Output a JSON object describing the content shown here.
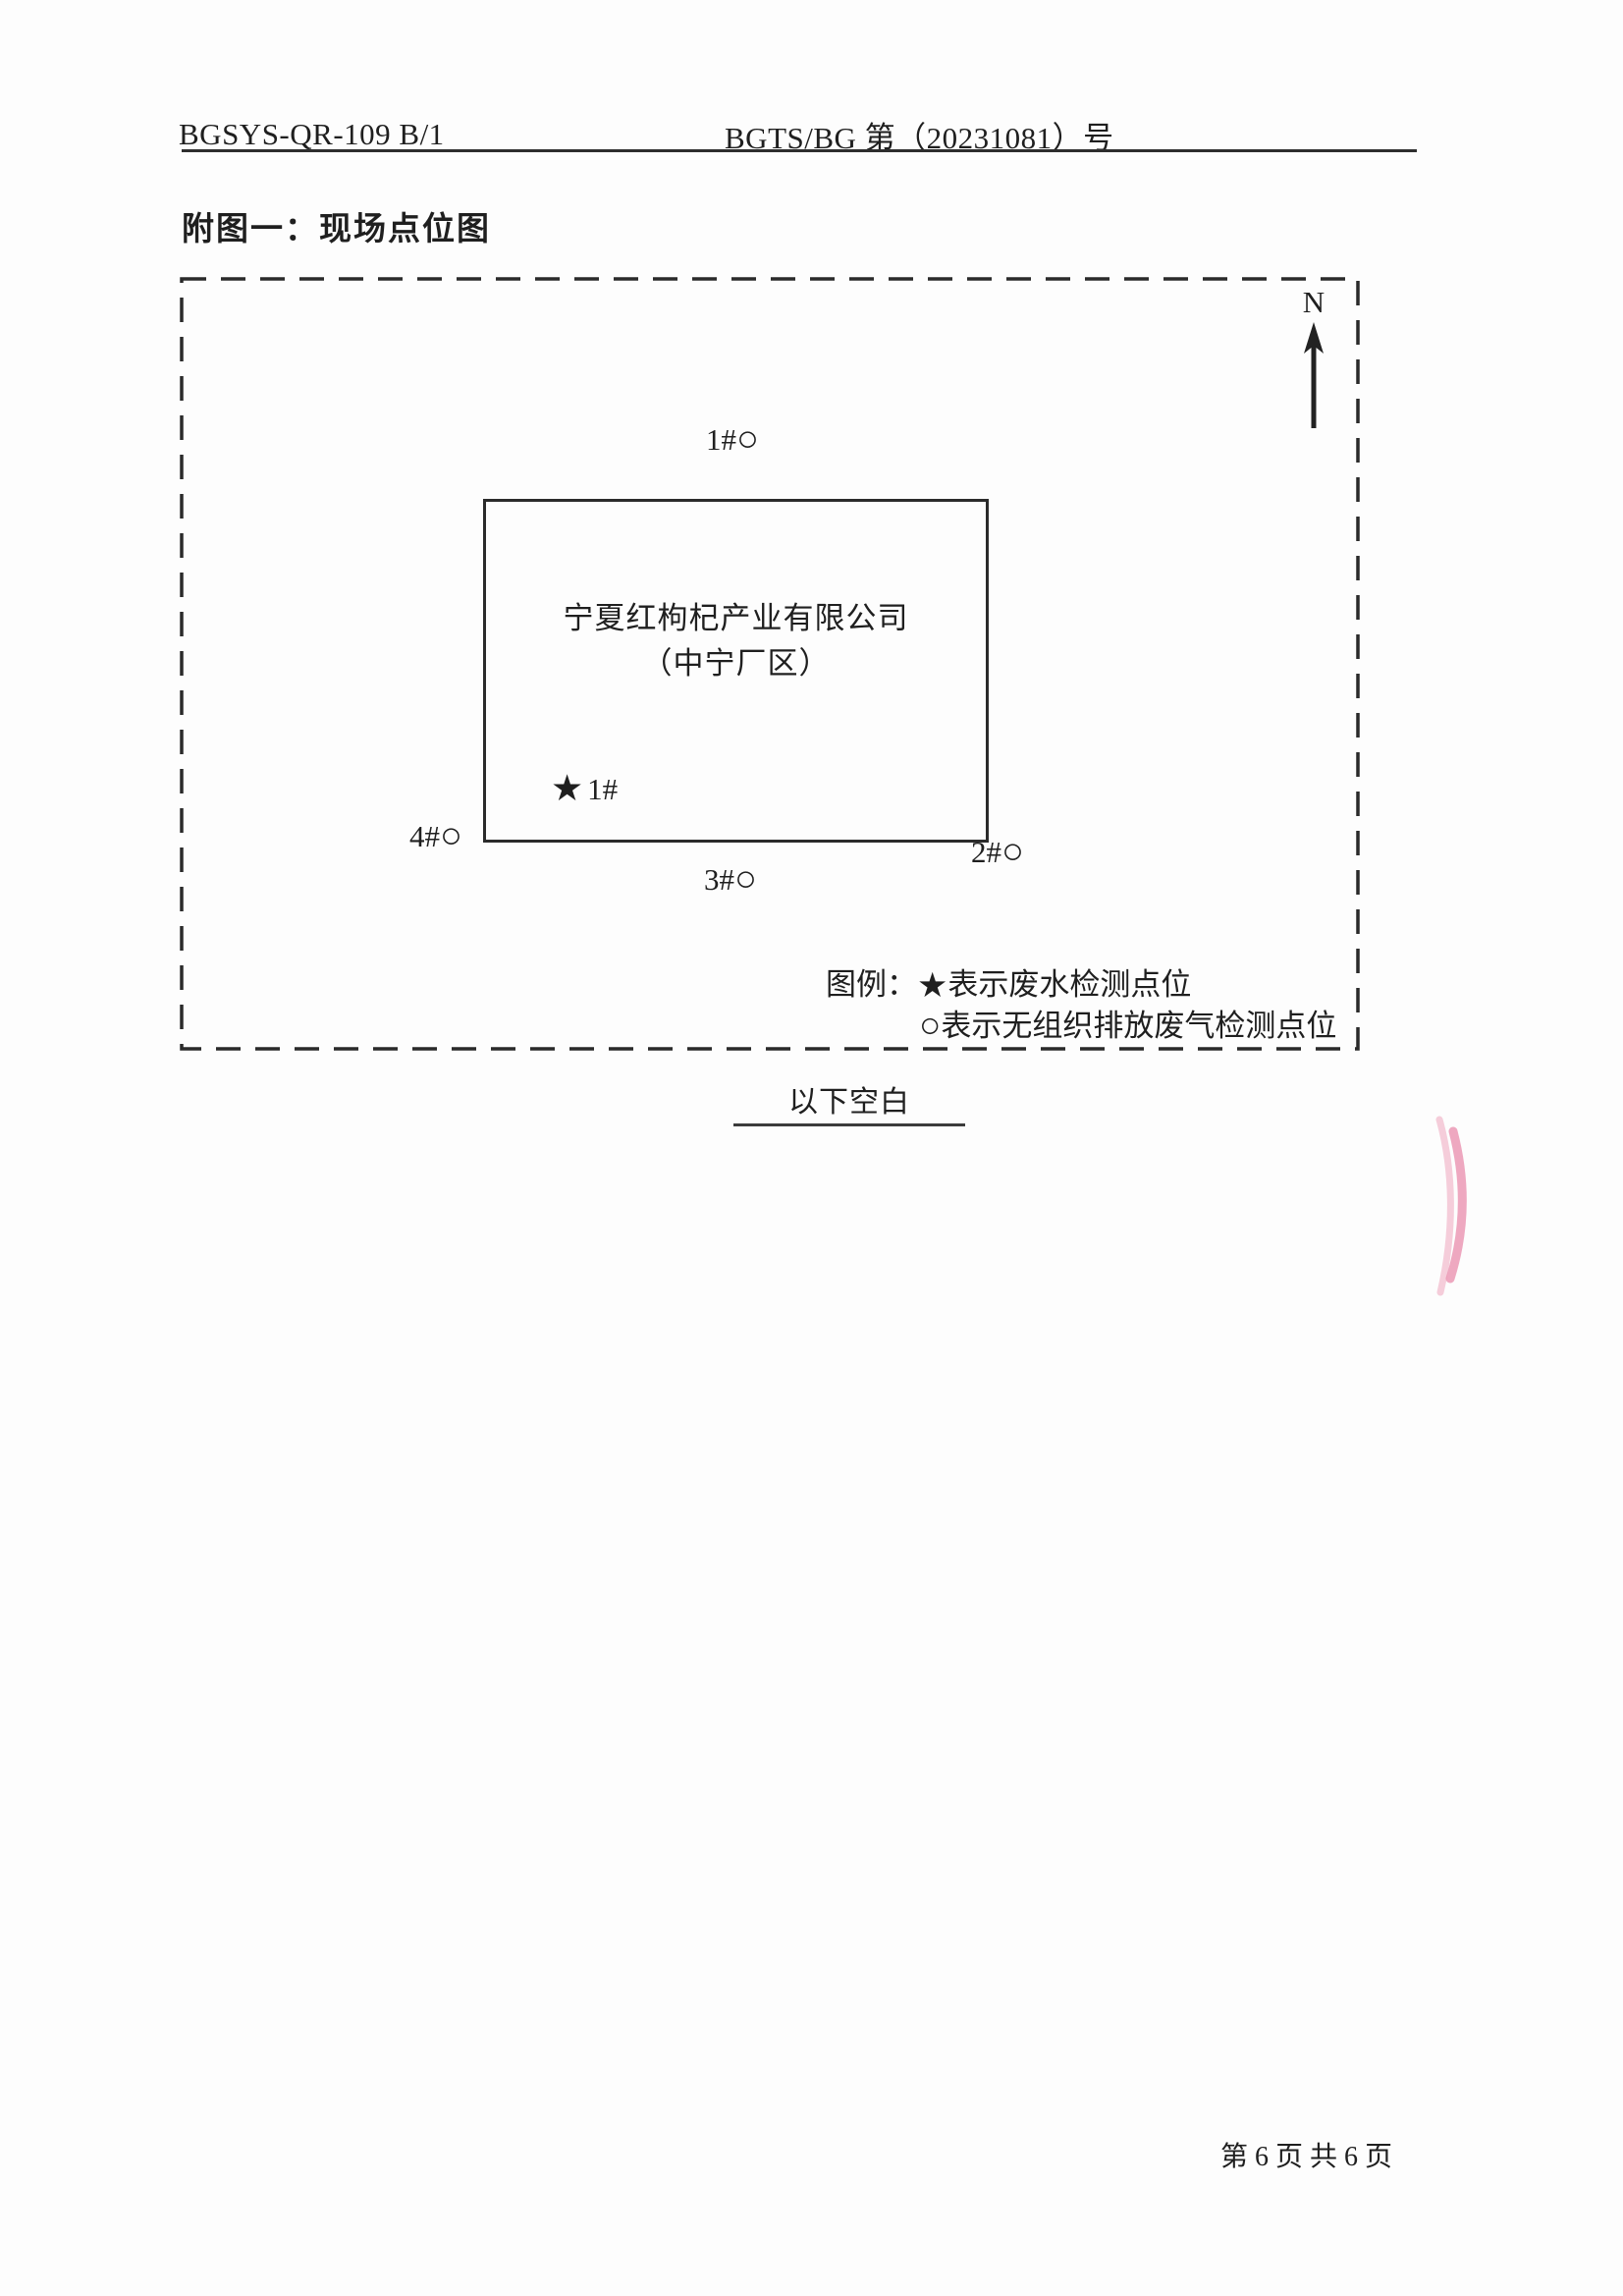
{
  "colors": {
    "ink": "#1f1f1f",
    "stamp_pink_light": "#f2bccd",
    "stamp_pink_strong": "#ea92b0"
  },
  "header": {
    "left_code": "BGSYS-QR-109 B/1",
    "right_code": "BGTS/BG 第（20231081）号"
  },
  "title": "附图一：现场点位图",
  "map": {
    "north_label": "N",
    "factory": {
      "name_line1": "宁夏红枸杞产业有限公司",
      "name_line2": "（中宁厂区）"
    },
    "wastewater_point": {
      "symbol": "★",
      "label": "1#"
    },
    "gas_points": [
      {
        "label": "1#",
        "symbol": "○"
      },
      {
        "label": "2#",
        "symbol": "○"
      },
      {
        "label": "3#",
        "symbol": "○"
      },
      {
        "label": "4#",
        "symbol": "○"
      }
    ],
    "legend": {
      "title": "图例：",
      "items": [
        {
          "symbol": "★",
          "text": "表示废水检测点位"
        },
        {
          "symbol": "○",
          "text": "表示无组织排放废气检测点位"
        }
      ]
    }
  },
  "end_note": "以下空白",
  "footer": {
    "page_info": "第 6 页 共 6 页"
  }
}
